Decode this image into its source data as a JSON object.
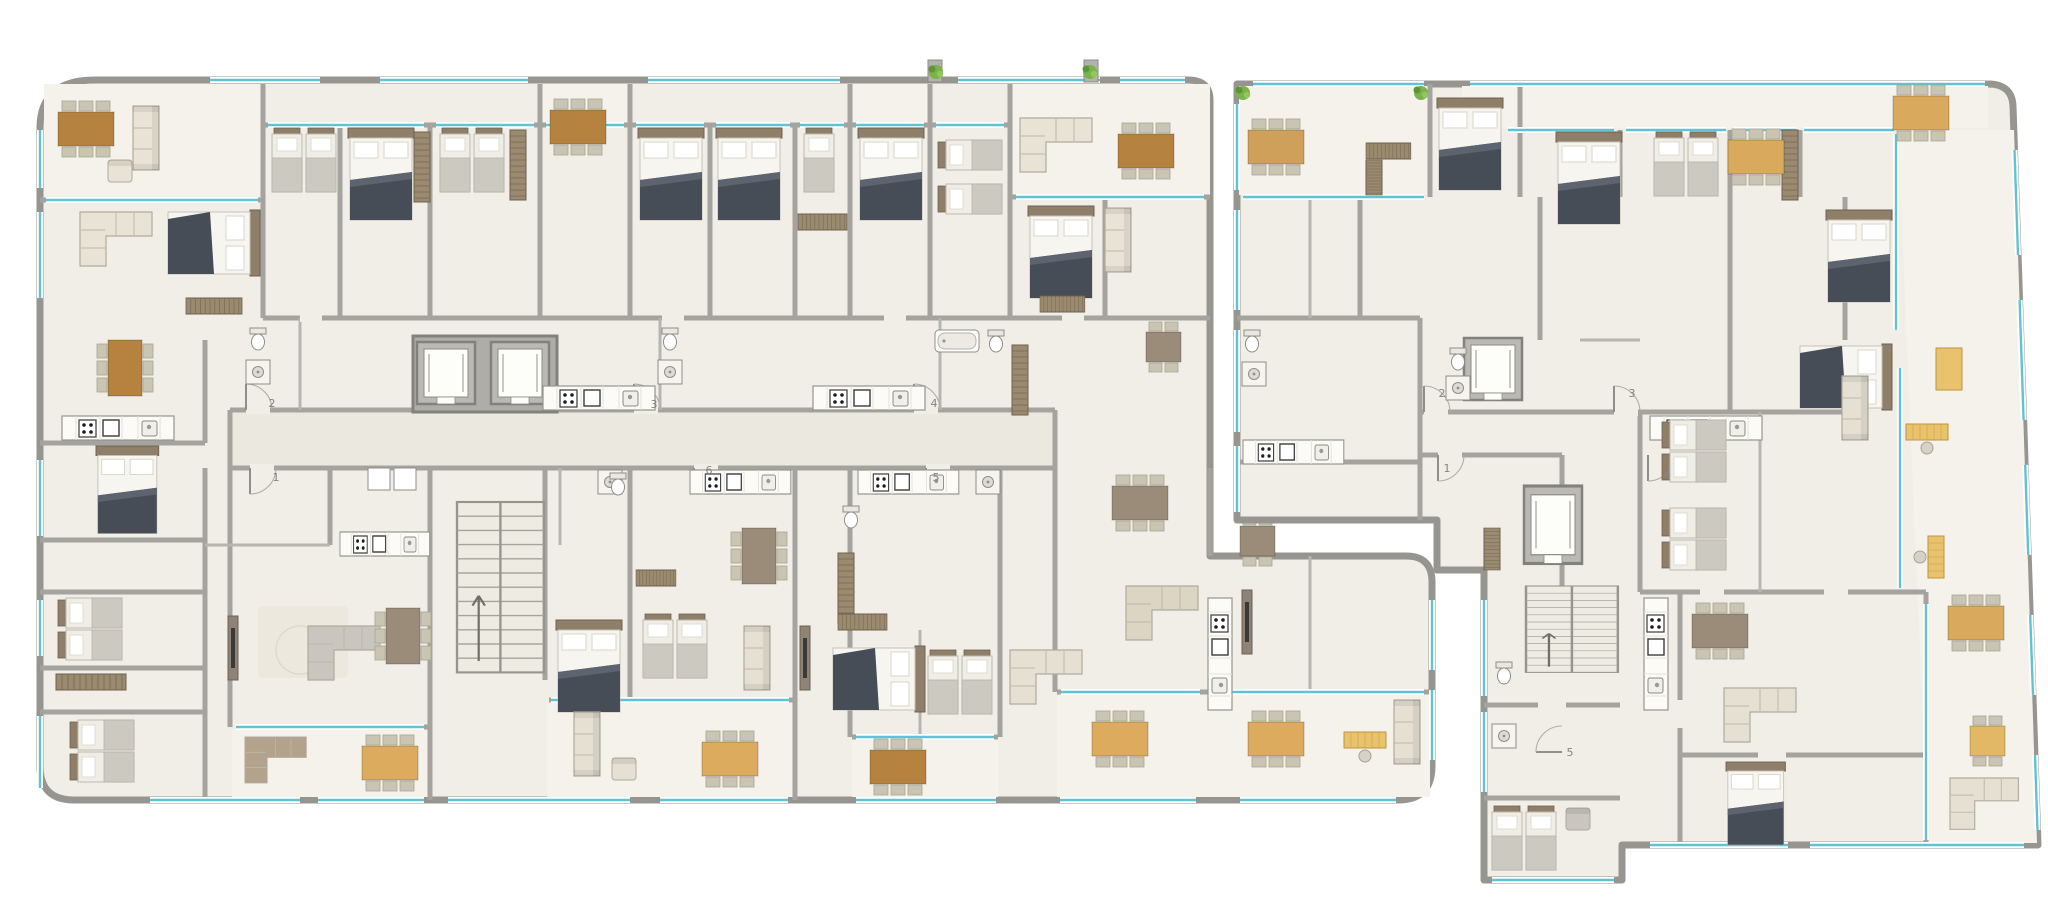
{
  "plan": {
    "kind": "residential-floor-plan",
    "left_building": {
      "units": [
        {
          "label": "1"
        },
        {
          "label": "2"
        },
        {
          "label": "3"
        },
        {
          "label": "4"
        },
        {
          "label": "5"
        },
        {
          "label": "6"
        }
      ]
    },
    "right_building": {
      "units": [
        {
          "label": "1"
        },
        {
          "label": "2"
        },
        {
          "label": "3"
        },
        {
          "label": "4"
        },
        {
          "label": "5"
        }
      ]
    }
  },
  "palette": {
    "background": "#ffffff",
    "floor": "#f1eee7",
    "terrace_floor": "#f5f2eb",
    "corridor_floor": "#ebe8e0",
    "wall": "#a4a39e",
    "wall_outline": "#96958f",
    "core_wall": "#82817c",
    "window_teal": "#5fc3d4",
    "table_wood_dark": "#b5823f",
    "table_oak": "#d9a95e",
    "table_gray_brown": "#9b8c7a",
    "sofa_beige": "#e6e0d3",
    "sofa_gray": "#c9c6bf",
    "bed_blanket_dark": "#474d57",
    "headboard_brown": "#8f7f68",
    "wardrobe_brown": "#9a8a70",
    "desk_yellow": "#e9c26d",
    "plant_green": "#79b34a",
    "chair": "#c9c5b2",
    "label_text": "#85847f"
  },
  "glyphs": [
    "double-bed",
    "single-bed",
    "dining-table",
    "sofa",
    "corner-sofa",
    "armchair",
    "wardrobe",
    "kitchen-counter",
    "stove",
    "sink",
    "toilet",
    "shower",
    "bathtub",
    "stairs",
    "elevator",
    "plant",
    "desk",
    "rug",
    "tv-cabinet",
    "door-arc"
  ]
}
